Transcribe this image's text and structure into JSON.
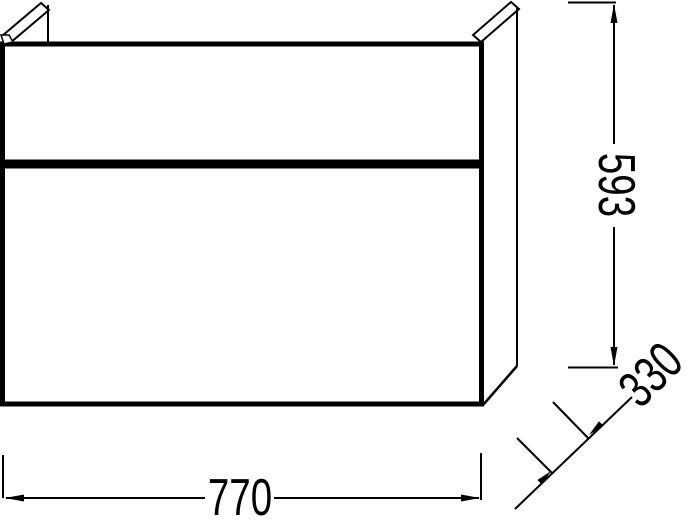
{
  "drawing": {
    "kind": "furniture-technical-dimension-drawing",
    "dimensions": {
      "width": "770",
      "height": "593",
      "depth": "330"
    },
    "colors": {
      "line": "#000000",
      "background": "#ffffff"
    }
  }
}
